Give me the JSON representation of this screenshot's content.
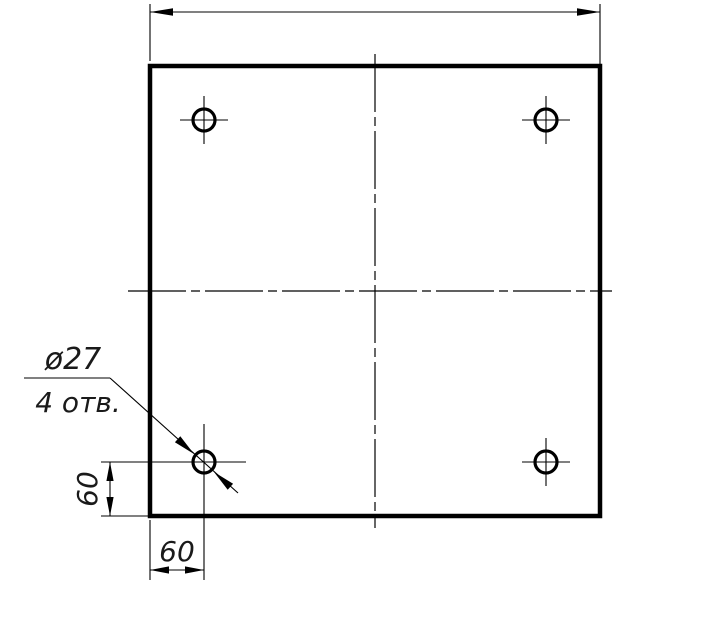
{
  "drawing": {
    "kind": "engineering-drawing: square plate with four drilled holes",
    "colors": {
      "line": "#000000",
      "background": "#ffffff"
    },
    "callout": {
      "line1": "ø27",
      "line2": "4 отв."
    },
    "dims": {
      "left_vertical": "60",
      "bottom_horizontal": "60"
    }
  }
}
